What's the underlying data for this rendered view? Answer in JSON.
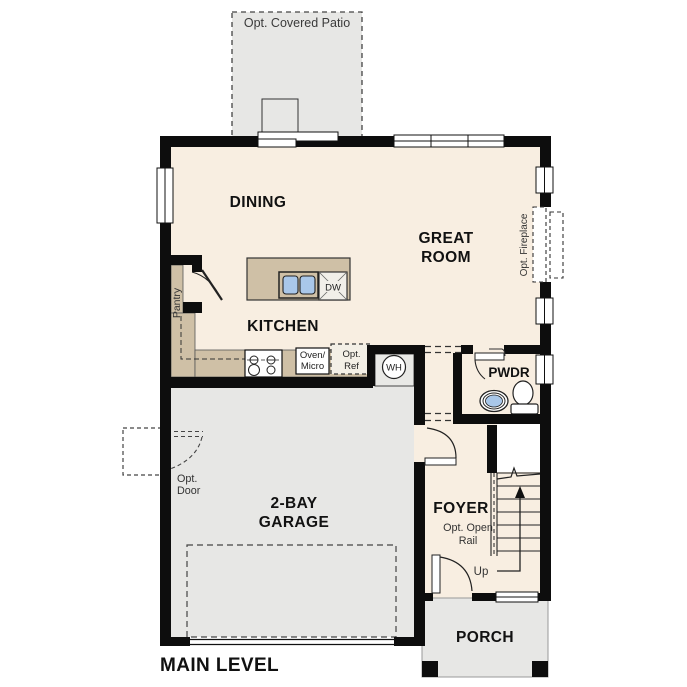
{
  "plan": {
    "title": "MAIN LEVEL",
    "rooms": {
      "patio": "Opt. Covered Patio",
      "dining": "DINING",
      "great1": "GREAT",
      "great2": "ROOM",
      "kitchen": "KITCHEN",
      "pantry": "Pantry",
      "pwdr": "PWDR",
      "garage1": "2-BAY",
      "garage2": "GARAGE",
      "foyer": "FOYER",
      "porch": "PORCH"
    },
    "labels": {
      "fireplace": "Opt. Fireplace",
      "oven1": "Oven/",
      "oven2": "Micro",
      "ref1": "Opt.",
      "ref2": "Ref",
      "wh": "WH",
      "dw": "DW",
      "optdoor1": "Opt.",
      "optdoor2": "Door",
      "rail1": "Opt. Open",
      "rail2": "Rail",
      "up": "Up"
    },
    "colors": {
      "floor": "#f8eee1",
      "concrete": "#e7e7e5",
      "counter": "#cfc0a6",
      "sink_blue": "#a9c7e9",
      "wall": "#0d0d0d"
    }
  }
}
